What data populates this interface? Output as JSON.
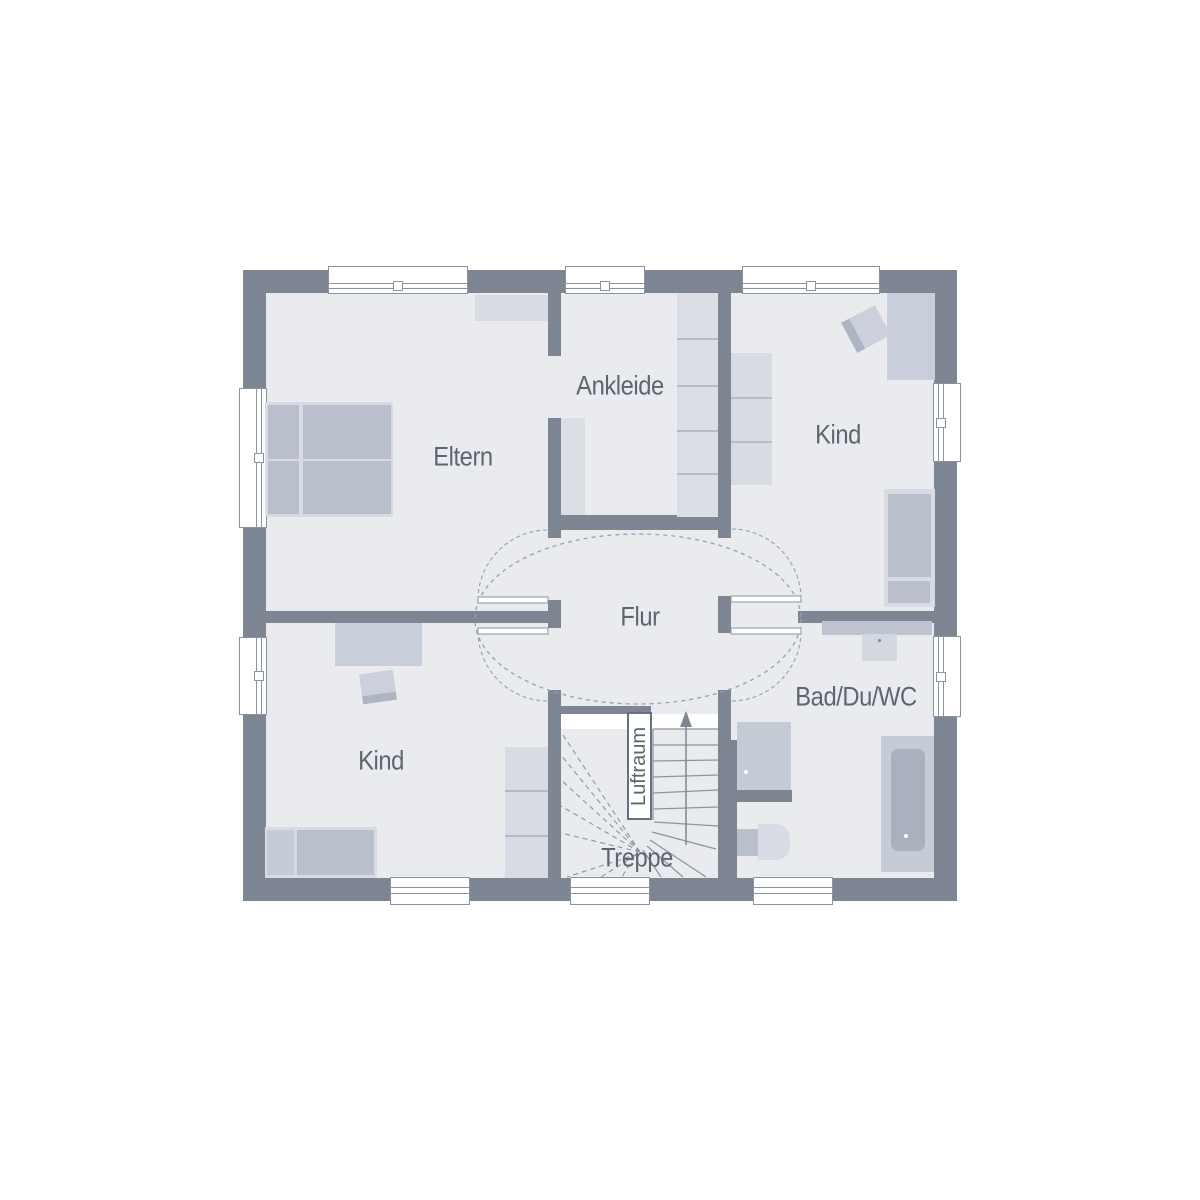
{
  "plan": {
    "type": "floor-plan",
    "rooms": {
      "eltern": {
        "label": "Eltern"
      },
      "ankleide": {
        "label": "Ankleide"
      },
      "kind_ne": {
        "label": "Kind"
      },
      "kind_sw": {
        "label": "Kind"
      },
      "flur": {
        "label": "Flur"
      },
      "bad": {
        "label": "Bad/Du/WC"
      },
      "treppe": {
        "label": "Treppe"
      },
      "luftraum": {
        "label": "Luftraum"
      }
    },
    "colors": {
      "wall": "#7e8694",
      "floor": "#e9ebef",
      "furniture_light": "#d8dbe3",
      "furniture_mid": "#c9cedb",
      "furniture_dark": "#b9bfcb",
      "outline": "#8b93a1",
      "label_text": "#5d6570",
      "background": "#ffffff"
    }
  }
}
